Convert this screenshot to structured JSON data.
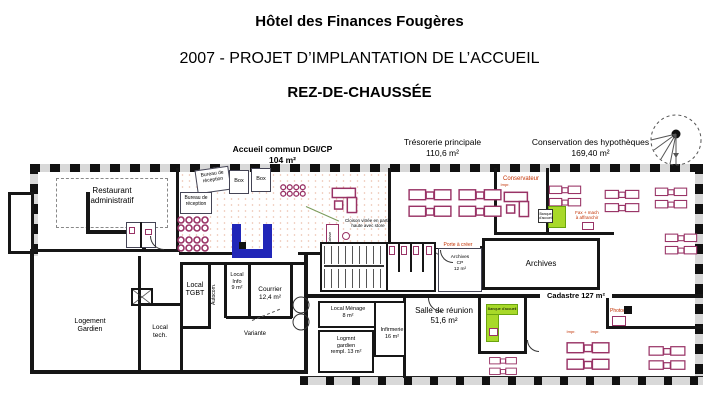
{
  "header": {
    "title": "Hôtel des Finances Fougères",
    "subtitle": "2007 - PROJET D’IMPLANTATION DE L’ACCUEIL",
    "floor": "REZ-DE-CHAUSSÉE"
  },
  "zones": {
    "accueil": {
      "name": "Accueil commun DGI/CP",
      "area": "104 m²"
    },
    "tresorerie": {
      "name": "Trésorerie principale",
      "area": "110,6 m²"
    },
    "hypotheques": {
      "name": "Conservation des hypothèques",
      "area": "169,40 m²"
    }
  },
  "rooms": {
    "restaurant": "Restaurant\nadministratif",
    "bureau_reception_1": "Bureau de\nréception",
    "bureau_reception_2": "Bureau de\nréception",
    "box_1": "Box",
    "box_2": "Box",
    "conservateur": "Conservateur",
    "archives_cp": "Archives\nCP\n12 m²",
    "archives": "Archives",
    "cadastre": "Cadastre 127 m²",
    "salle_reunion": "Salle de réunion\n51,6 m²",
    "local_menage": "Local Ménage\n8 m²",
    "infirmerie": "Infirmerie\n16 m²",
    "logement_gardien_rempl": "Logmnt\ngardien\nrempl. 13 m²",
    "local_tgbt": "Local\nTGBT",
    "autocom": "Autocom.",
    "local_info": "Local\nInfo\n9 m²",
    "courrier": "Courrier\n12,4 m²",
    "logement_gardien": "Logement\nGardien",
    "local_tech": "Local\ntech."
  },
  "annotations": {
    "cloison_vitree": "Cloison vitrée en partie\nhaute avec store",
    "porte_a_creer": "Porte à créer",
    "variante": "Variante",
    "photocopieur": "Photoc.",
    "fax": "Fax + mach\nà affranchir",
    "banque_accueil_1": "Banque\nd'accueil",
    "banque_accueil_2": "Banque d'accueil",
    "caisse": "Caisse",
    "imprimante": "Impr."
  },
  "colors": {
    "wall": "#161616",
    "furniture_purple": "#993366",
    "reception_desk_blue": "#2126b8",
    "highlight_green": "#a8d929",
    "note_red": "#c23000"
  }
}
